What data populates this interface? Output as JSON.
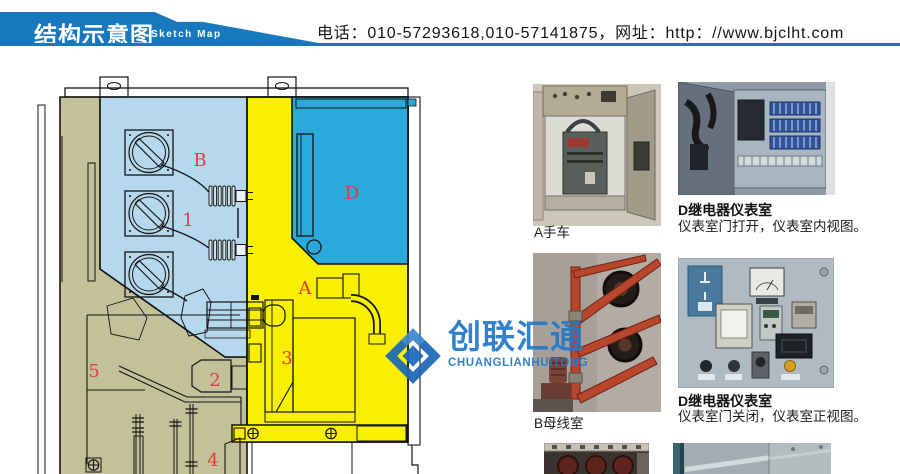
{
  "header": {
    "title": "结构示意图",
    "subtitle": "Sketch Map",
    "contact": "电话：010-57293618,010-57141875，网址：http：//www.bjclht.com",
    "banner_color": "#1878be"
  },
  "diagram": {
    "labels": {
      "b": "B",
      "n1": "1",
      "d": "D",
      "a": "A",
      "n3": "3",
      "n2": "2",
      "n5": "5",
      "n4": "4"
    },
    "colors": {
      "handcart_room": "#b6d8ec",
      "instrument_room": "#2aa9da",
      "breaker_room": "#f9f000",
      "cable_room": "#c3c19a",
      "label_red": "#e23a3e"
    }
  },
  "watermark": {
    "name_cn": "创联汇通",
    "name_en": "CHUANGLIANHUITONG",
    "color": "#2478c8"
  },
  "photos": {
    "a": {
      "caption": "A手车"
    },
    "d_open": {
      "title": "D继电器仪表室",
      "subtitle": "仪表室门打开，仪表室内视图。"
    },
    "b": {
      "caption": "B母线室"
    },
    "d_closed": {
      "title": "D继电器仪表室",
      "subtitle": "仪表室门关闭，仪表室正视图。"
    }
  }
}
